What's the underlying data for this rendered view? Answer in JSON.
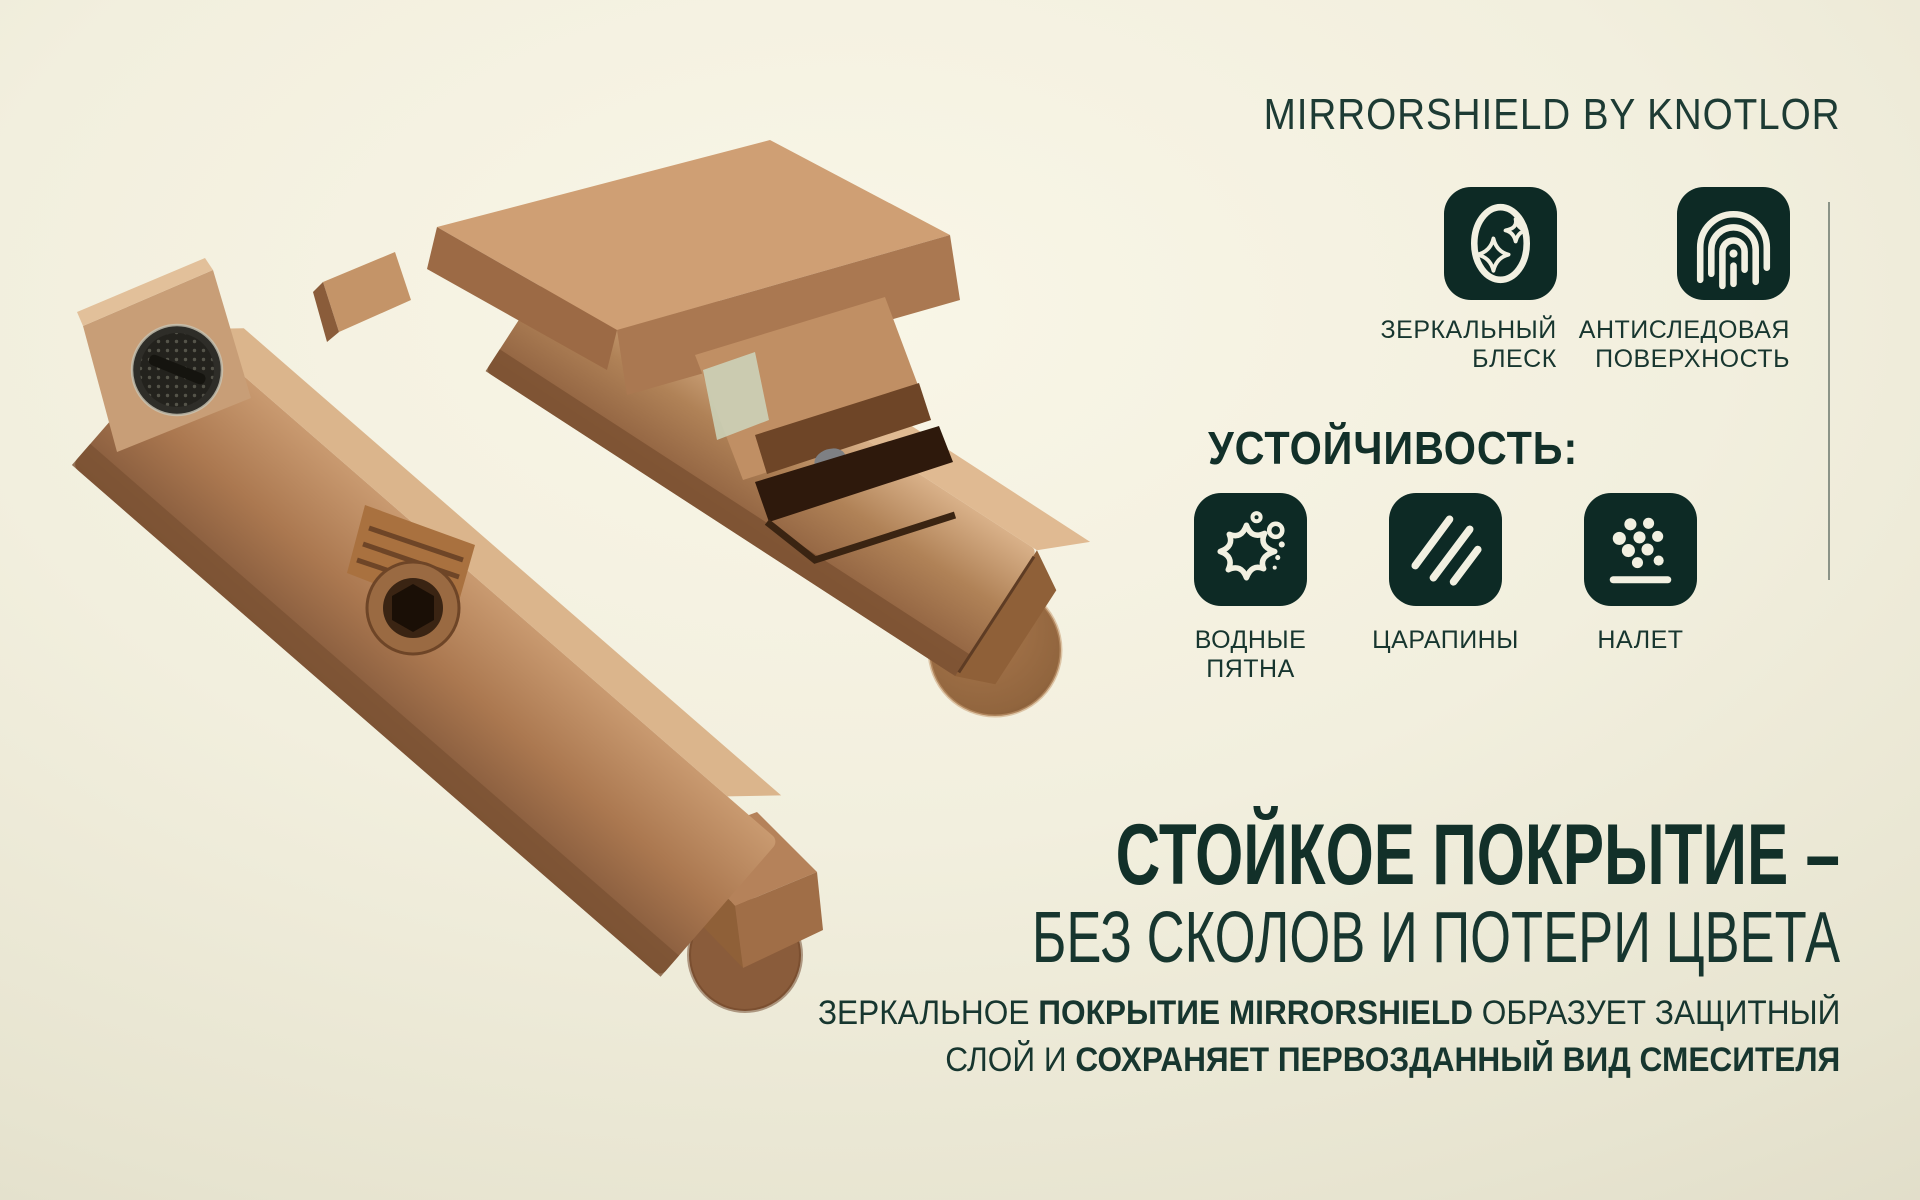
{
  "page": {
    "title": "MIRRORSHIELD BY KNOTLOR"
  },
  "product": {
    "alt": "Настенный смеситель для ванны, бронзовое покрытие",
    "finish": "bronze"
  },
  "benefits": {
    "items": [
      {
        "icon": "mirror-shine-icon",
        "line1": "ЗЕРКАЛЬНЫЙ",
        "line2": "БЛЕСК"
      },
      {
        "icon": "fingerprint-icon",
        "line1": "АНТИСЛЕДОВАЯ",
        "line2": "ПОВЕРХНОСТЬ"
      }
    ]
  },
  "resistance": {
    "heading": "УСТОЙЧИВОСТЬ:",
    "items": [
      {
        "icon": "water-stain-icon",
        "line1": "ВОДНЫЕ",
        "line2": "ПЯТНА"
      },
      {
        "icon": "scratches-icon",
        "line1": "ЦАРАПИНЫ",
        "line2": ""
      },
      {
        "icon": "deposit-icon",
        "line1": "НАЛЕТ",
        "line2": ""
      }
    ]
  },
  "claim": {
    "heading": "СТОЙКОЕ ПОКРЫТИЕ –",
    "subheading": "БЕЗ СКОЛОВ И ПОТЕРИ ЦВЕТА",
    "body": {
      "l1a": "ЗЕРКАЛЬНОЕ ",
      "l1b": "ПОКРЫТИЕ MIRRORSHIELD",
      "l1c": " ОБРАЗУЕТ ЗАЩИТНЫЙ",
      "l2a": "СЛОЙ И ",
      "l2b": "СОХРАНЯЕТ ПЕРВОЗДАННЫЙ ВИД СМЕСИТЕЛЯ"
    }
  },
  "colors": {
    "text": "#17362f",
    "heading": "#123029",
    "tile_bg": "#0d2a25",
    "tile_glyph": "#f2f0e1",
    "divider": "#8b9387",
    "bg_center": "#f9f6e7",
    "bg_edge": "#d8d4bf",
    "bronze_light": "#d2a57c",
    "bronze_mid": "#a4714b",
    "bronze_dark": "#6e4527"
  }
}
